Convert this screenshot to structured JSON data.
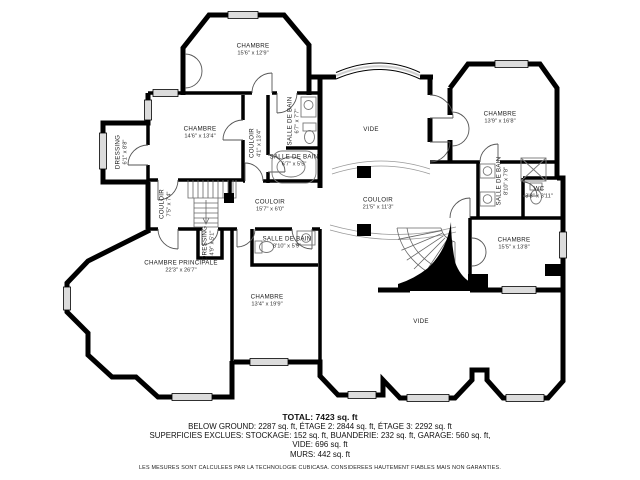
{
  "colors": {
    "wall": "#000000",
    "window": "#dcdcdc",
    "door_line": "#555555",
    "fixture_line": "#777777",
    "background": "#ffffff"
  },
  "rooms": [
    {
      "name": "CHAMBRE",
      "dims": "15'6\" x 12'9\"",
      "x": 253,
      "y": 50,
      "rot": 0
    },
    {
      "name": "CHAMBRE",
      "dims": "14'6\" x 13'4\"",
      "x": 200,
      "y": 133,
      "rot": 0
    },
    {
      "name": "DRESSING",
      "dims": "6'1\" x 8'8\"",
      "x": 122,
      "y": 152,
      "rot": -90
    },
    {
      "name": "COULOIR",
      "dims": "4'1\" x 13'4\"",
      "x": 256,
      "y": 143,
      "rot": -90
    },
    {
      "name": "SALLE DE BAIN",
      "dims": "6'7\" x 7'7\"",
      "x": 294,
      "y": 121,
      "rot": -90
    },
    {
      "name": "SALLE DE BAIN",
      "dims": "6'7\" x 5'5\"",
      "x": 294,
      "y": 161,
      "rot": 0
    },
    {
      "name": "VIDE",
      "dims": "",
      "x": 371,
      "y": 130,
      "rot": 0
    },
    {
      "name": "CHAMBRE",
      "dims": "13'9\" x 16'8\"",
      "x": 500,
      "y": 118,
      "rot": 0
    },
    {
      "name": "SALLE DE BAIN",
      "dims": "8'10\" x 7'8\"",
      "x": 503,
      "y": 181,
      "rot": -90
    },
    {
      "name": "WC",
      "dims": "3'8\" x 3'11\"",
      "x": 539,
      "y": 193,
      "rot": 0
    },
    {
      "name": "COULOIR",
      "dims": "7'5\" x 7'4\"",
      "x": 166,
      "y": 204,
      "rot": -90
    },
    {
      "name": "COULOIR",
      "dims": "15'7\" x 6'0\"",
      "x": 270,
      "y": 206,
      "rot": 0
    },
    {
      "name": "COULOIR",
      "dims": "21'5\" x 11'3\"",
      "x": 378,
      "y": 204,
      "rot": 0
    },
    {
      "name": "DRESSING",
      "dims": "4'9\" x 5'1\"",
      "x": 209,
      "y": 243,
      "rot": -90
    },
    {
      "name": "SALLE DE BAIN",
      "dims": "8'10\" x 5'9\"",
      "x": 287,
      "y": 243,
      "rot": 0
    },
    {
      "name": "CHAMBRE PRINCIPALE",
      "dims": "22'3\" x 26'7\"",
      "x": 181,
      "y": 267,
      "rot": 0
    },
    {
      "name": "CHAMBRE",
      "dims": "13'4\" x 19'9\"",
      "x": 267,
      "y": 301,
      "rot": 0
    },
    {
      "name": "CHAMBRE",
      "dims": "15'5\" x 13'8\"",
      "x": 514,
      "y": 244,
      "rot": 0
    },
    {
      "name": "VIDE",
      "dims": "",
      "x": 421,
      "y": 322,
      "rot": 0
    }
  ],
  "summary": {
    "total": "TOTAL: 7423 sq. ft",
    "levels": "BELOW GROUND: 2287 sq. ft, ÉTAGE 2: 2844 sq. ft, ÉTAGE 3: 2292 sq. ft",
    "excluded": "SUPERFICIES EXCLUES: STOCKAGE: 152 sq. ft, BUANDERIE: 232 sq. ft, GARAGE: 560 sq. ft,",
    "vide": "VIDE: 696 sq. ft",
    "murs": "MURS: 442 sq. ft",
    "disclaimer": "LES MESURES SONT CALCULEES PAR LA TECHNOLOGIE CUBICASA. CONSIDEREES HAUTEMENT FIABLES MAIS NON GARANTIES."
  }
}
